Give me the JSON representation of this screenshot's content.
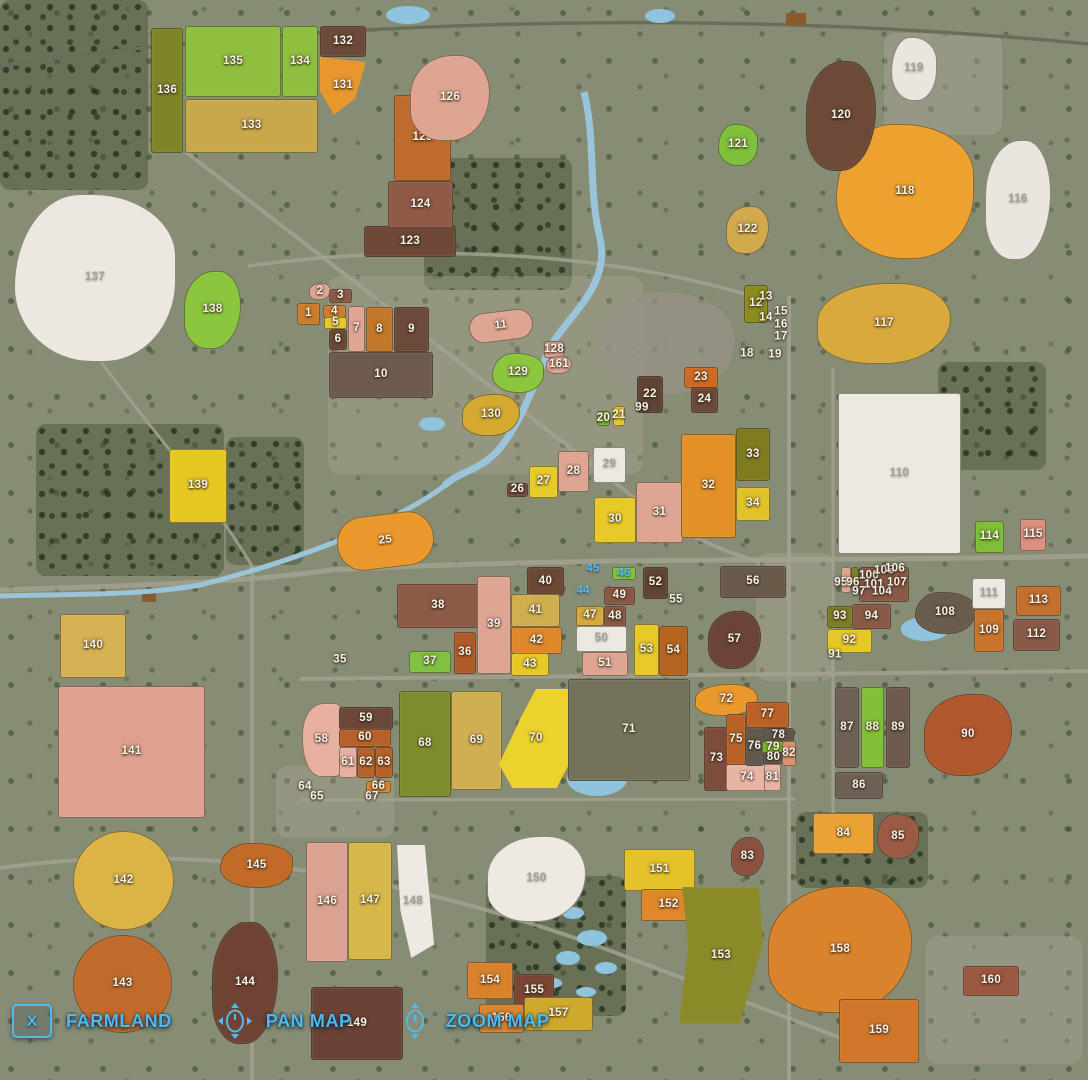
{
  "hud": {
    "close_key": "X",
    "farmland_label": "FARMLAND",
    "pan_label": "PAN MAP",
    "zoom_label": "ZOOM MAP",
    "accent_color": "#4dbbee",
    "pan_icon": "mouse-pan-icon",
    "zoom_icon": "mouse-zoom-icon"
  },
  "map": {
    "base_color": "#878d74",
    "label_default_color": "#f7f3ea",
    "fields": [
      [
        1,
        297,
        303,
        23,
        22,
        "#cc7d2a",
        "r"
      ],
      [
        2,
        309,
        283,
        22,
        17,
        "#dfa593",
        "b1"
      ],
      [
        3,
        329,
        289,
        23,
        14,
        "#8a5a44",
        "r"
      ],
      [
        4,
        323,
        305,
        23,
        13,
        "#cc7d2a",
        "r"
      ],
      [
        5,
        324,
        317,
        23,
        12,
        "#e7c928",
        "r"
      ],
      [
        6,
        329,
        329,
        18,
        21,
        "#6b4736",
        "r"
      ],
      [
        7,
        348,
        306,
        17,
        46,
        "#dfa593",
        "r"
      ],
      [
        8,
        366,
        307,
        27,
        45,
        "#c1782a",
        "r"
      ],
      [
        9,
        394,
        307,
        35,
        45,
        "#6b4a3a",
        "r"
      ],
      [
        10,
        329,
        352,
        104,
        46,
        "#6e5a4f",
        "r"
      ],
      [
        11,
        469,
        311,
        64,
        30,
        "#dfa593",
        "pill"
      ],
      [
        12,
        744,
        285,
        24,
        38,
        "#8b8b20",
        "r"
      ],
      [
        13,
        766,
        297
      ],
      [
        14,
        766,
        318
      ],
      [
        15,
        781,
        312
      ],
      [
        16,
        781,
        325
      ],
      [
        17,
        781,
        337
      ],
      [
        18,
        747,
        354
      ],
      [
        19,
        775,
        355
      ],
      [
        20,
        597,
        411,
        13,
        15,
        "#7ab32e",
        "r"
      ],
      [
        21,
        613,
        406,
        12,
        20,
        "#e7c928",
        "r"
      ],
      [
        22,
        637,
        376,
        26,
        37,
        "#5f4434",
        "r"
      ],
      [
        23,
        684,
        367,
        34,
        21,
        "#cc6a24",
        "r"
      ],
      [
        24,
        691,
        387,
        27,
        26,
        "#6b4a3c",
        "r"
      ],
      [
        25,
        337,
        514,
        97,
        54,
        "#e9992b",
        "pill"
      ],
      [
        26,
        507,
        483,
        21,
        14,
        "#6f4a3a",
        "r"
      ],
      [
        27,
        529,
        466,
        29,
        32,
        "#e8cb28",
        "r"
      ],
      [
        28,
        558,
        451,
        31,
        41,
        "#dfa593",
        "r"
      ],
      [
        29,
        593,
        447,
        33,
        36,
        "#ece8e2",
        "r",
        "gray"
      ],
      [
        30,
        594,
        497,
        42,
        46,
        "#e7c928",
        "r"
      ],
      [
        31,
        636,
        482,
        47,
        61,
        "#dfa593",
        "r"
      ],
      [
        32,
        681,
        434,
        55,
        104,
        "#e39127",
        "r"
      ],
      [
        33,
        736,
        428,
        34,
        53,
        "#7f7c20",
        "r"
      ],
      [
        34,
        736,
        487,
        34,
        34,
        "#e0c22a",
        "r"
      ],
      [
        35,
        340,
        660
      ],
      [
        36,
        454,
        632,
        22,
        42,
        "#b05a28",
        "r"
      ],
      [
        37,
        409,
        651,
        42,
        22,
        "#7fc242",
        "r"
      ],
      [
        38,
        397,
        584,
        82,
        44,
        "#8c5a46",
        "r"
      ],
      [
        39,
        477,
        576,
        34,
        98,
        "#dfa593",
        "r"
      ],
      [
        40,
        527,
        567,
        37,
        29,
        "#6b4736",
        "r"
      ],
      [
        41,
        511,
        594,
        49,
        33,
        "#cfae4f",
        "r"
      ],
      [
        42,
        511,
        627,
        51,
        27,
        "#e0872b",
        "r"
      ],
      [
        43,
        511,
        653,
        38,
        23,
        "#e7c928",
        "r"
      ],
      [
        44,
        583,
        591,
        null,
        null,
        null,
        null,
        "blue"
      ],
      [
        45,
        593,
        569,
        null,
        null,
        null,
        null,
        "blue"
      ],
      [
        46,
        612,
        567,
        24,
        13,
        "#7fc242",
        "r",
        "blue"
      ],
      [
        47,
        576,
        606,
        28,
        20,
        "#d2a93c",
        "r"
      ],
      [
        48,
        604,
        606,
        22,
        22,
        "#8a5744",
        "r"
      ],
      [
        49,
        604,
        587,
        31,
        18,
        "#8a5744",
        "r"
      ],
      [
        50,
        576,
        626,
        51,
        26,
        "#ece8e2",
        "r",
        "gray"
      ],
      [
        51,
        582,
        652,
        46,
        24,
        "#dfa593",
        "r"
      ],
      [
        52,
        643,
        567,
        25,
        32,
        "#5f4434",
        "r"
      ],
      [
        53,
        634,
        624,
        25,
        52,
        "#e7c928",
        "r"
      ],
      [
        54,
        659,
        626,
        29,
        50,
        "#b5641f",
        "r"
      ],
      [
        55,
        676,
        600
      ],
      [
        56,
        720,
        566,
        66,
        32,
        "#6a5a4a",
        "r"
      ],
      [
        57,
        708,
        611,
        53,
        58,
        "#6b4435",
        "b1"
      ],
      [
        58,
        302,
        703,
        39,
        74,
        "#e8b0a0",
        "q"
      ],
      [
        59,
        339,
        707,
        54,
        23,
        "#6b4738",
        "r"
      ],
      [
        60,
        339,
        729,
        52,
        18,
        "#b56129",
        "r"
      ],
      [
        61,
        339,
        747,
        18,
        31,
        "#e8b0a0",
        "r"
      ],
      [
        62,
        357,
        747,
        18,
        31,
        "#b56129",
        "r"
      ],
      [
        63,
        375,
        747,
        18,
        31,
        "#b56129",
        "r"
      ],
      [
        64,
        305,
        787
      ],
      [
        65,
        317,
        797
      ],
      [
        66,
        366,
        781,
        25,
        12,
        "#d9862e",
        "r"
      ],
      [
        67,
        372,
        797
      ],
      [
        68,
        399,
        691,
        52,
        106,
        "#7f8c2d",
        "r"
      ],
      [
        69,
        451,
        691,
        51,
        99,
        "#cfaf52",
        "r"
      ],
      [
        70,
        499,
        689,
        74,
        99,
        "#ecd22c",
        "w70"
      ],
      [
        71,
        568,
        679,
        122,
        102,
        "#74735a",
        "r"
      ],
      [
        72,
        695,
        684,
        63,
        32,
        "#e9992b",
        "b1"
      ],
      [
        73,
        704,
        727,
        25,
        64,
        "#7d4c3c",
        "r"
      ],
      [
        74,
        726,
        764,
        42,
        27,
        "#e8b5a5",
        "r"
      ],
      [
        75,
        726,
        714,
        20,
        51,
        "#b96228",
        "r"
      ],
      [
        76,
        745,
        727,
        19,
        39,
        "#62584e",
        "r"
      ],
      [
        77,
        746,
        702,
        43,
        26,
        "#b96228",
        "r"
      ],
      [
        78,
        763,
        728,
        31,
        15,
        "#5f564c",
        "r"
      ],
      [
        79,
        762,
        741,
        22,
        13,
        "#76b82a",
        "r"
      ],
      [
        80,
        763,
        752,
        21,
        12,
        "#5f564c",
        "r"
      ],
      [
        81,
        764,
        764,
        17,
        27,
        "#e8b5a5",
        "r"
      ],
      [
        82,
        782,
        741,
        14,
        25,
        "#d8936b",
        "r"
      ],
      [
        83,
        731,
        837,
        33,
        39,
        "#8a5140",
        "b1"
      ],
      [
        84,
        813,
        813,
        61,
        41,
        "#e9a233",
        "r"
      ],
      [
        85,
        877,
        814,
        42,
        45,
        "#9a5a44",
        "b2"
      ],
      [
        86,
        835,
        772,
        48,
        27,
        "#6e6055",
        "r"
      ],
      [
        87,
        835,
        687,
        24,
        81,
        "#6e6055",
        "r"
      ],
      [
        88,
        861,
        687,
        23,
        81,
        "#82c136",
        "r"
      ],
      [
        89,
        886,
        687,
        24,
        81,
        "#6e5a4e",
        "r"
      ],
      [
        90,
        924,
        694,
        88,
        82,
        "#b0572e",
        "b1"
      ],
      [
        91,
        835,
        655
      ],
      [
        92,
        827,
        629,
        45,
        24,
        "#e5c726",
        "r"
      ],
      [
        93,
        827,
        606,
        26,
        22,
        "#7d7c28",
        "r"
      ],
      [
        94,
        852,
        604,
        39,
        25,
        "#8a5a48",
        "r"
      ],
      [
        0,
        841,
        567,
        10,
        26,
        "#dfa593",
        "r"
      ],
      [
        0,
        851,
        567,
        8,
        22,
        "#7d7c28",
        "r"
      ],
      [
        0,
        865,
        567,
        10,
        14,
        "#e5c726",
        "r"
      ],
      [
        0,
        859,
        567,
        50,
        35,
        "#8a5a48",
        "r"
      ],
      [
        95,
        841,
        583
      ],
      [
        96,
        853,
        583
      ],
      [
        97,
        859,
        592
      ],
      [
        99,
        642,
        408
      ],
      [
        100,
        869,
        576
      ],
      [
        101,
        874,
        585
      ],
      [
        104,
        882,
        592
      ],
      [
        105,
        884,
        571
      ],
      [
        106,
        895,
        569
      ],
      [
        107,
        897,
        583
      ],
      [
        108,
        915,
        592,
        60,
        42,
        "#6a5c4c",
        "b2"
      ],
      [
        109,
        974,
        609,
        30,
        43,
        "#c8742c",
        "r"
      ],
      [
        110,
        838,
        393,
        123,
        161,
        "#ece8e2",
        "r",
        "gray"
      ],
      [
        111,
        972,
        578,
        34,
        31,
        "#ece8e2",
        "r",
        "gray"
      ],
      [
        112,
        1013,
        619,
        47,
        32,
        "#8a5a48",
        "r"
      ],
      [
        113,
        1016,
        586,
        45,
        30,
        "#c2702d",
        "r"
      ],
      [
        114,
        975,
        521,
        29,
        32,
        "#7dbf35",
        "r"
      ],
      [
        115,
        1020,
        519,
        26,
        32,
        "#d99080",
        "r"
      ],
      [
        116,
        985,
        140,
        66,
        120,
        "#eae6df",
        "b1",
        "gray"
      ],
      [
        117,
        817,
        283,
        134,
        81,
        "#d9a93e",
        "b1"
      ],
      [
        118,
        836,
        124,
        138,
        135,
        "#eda22f",
        "b2"
      ],
      [
        119,
        891,
        37,
        46,
        64,
        "#eae6df",
        "b2",
        "gray"
      ],
      [
        120,
        806,
        61,
        70,
        110,
        "#6d4937",
        "b1"
      ],
      [
        121,
        718,
        124,
        40,
        42,
        "#7ec13c",
        "b2"
      ],
      [
        122,
        726,
        206,
        43,
        48,
        "#d3a94e",
        "b1"
      ],
      [
        123,
        364,
        226,
        92,
        31,
        "#6f4736",
        "r"
      ],
      [
        124,
        388,
        181,
        65,
        47,
        "#8f5b46",
        "r"
      ],
      [
        125,
        394,
        95,
        57,
        86,
        "#bf6b2d",
        "r"
      ],
      [
        126,
        410,
        55,
        80,
        86,
        "#dfa593",
        "b1"
      ],
      [
        128,
        544,
        341,
        20,
        17,
        "#dfa593",
        "r"
      ],
      [
        129,
        492,
        353,
        52,
        40,
        "#8cc63f",
        "b2"
      ],
      [
        130,
        462,
        394,
        58,
        42,
        "#d3a930",
        "b1"
      ],
      [
        131,
        320,
        57,
        46,
        58,
        "#e8962e",
        "w131"
      ],
      [
        132,
        320,
        26,
        46,
        31,
        "#6b4a3a",
        "r"
      ],
      [
        133,
        185,
        99,
        133,
        54,
        "#c9a84c",
        "r"
      ],
      [
        134,
        282,
        26,
        36,
        71,
        "#8fbf3f",
        "r"
      ],
      [
        135,
        185,
        26,
        96,
        71,
        "#8fbf3f",
        "r"
      ],
      [
        136,
        151,
        28,
        32,
        125,
        "#7e8428",
        "r"
      ],
      [
        137,
        14,
        194,
        162,
        168,
        "#ece8e0",
        "b2",
        "gray"
      ],
      [
        138,
        184,
        271,
        57,
        78,
        "#8cc63f",
        "b1"
      ],
      [
        139,
        169,
        449,
        58,
        74,
        "#e5c722",
        "r"
      ],
      [
        140,
        60,
        614,
        66,
        64,
        "#d6b254",
        "r"
      ],
      [
        141,
        58,
        686,
        147,
        132,
        "#dfa08f",
        "r"
      ],
      [
        142,
        73,
        831,
        101,
        99,
        "#dcb446",
        "ci"
      ],
      [
        143,
        73,
        935,
        99,
        98,
        "#c06b2b",
        "ci"
      ],
      [
        144,
        212,
        922,
        66,
        122,
        "#6e4334",
        "b1"
      ],
      [
        145,
        220,
        843,
        73,
        45,
        "#c26a28",
        "b2"
      ],
      [
        146,
        306,
        842,
        42,
        120,
        "#dba292",
        "r"
      ],
      [
        147,
        348,
        842,
        44,
        118,
        "#d5b74a",
        "r"
      ],
      [
        148,
        392,
        845,
        42,
        113,
        "#efe9e4",
        "w148",
        "gray"
      ],
      [
        149,
        311,
        987,
        92,
        73,
        "#6b4336",
        "r"
      ],
      [
        150,
        487,
        836,
        99,
        86,
        "#efe9e4",
        "b1",
        "gray"
      ],
      [
        151,
        624,
        849,
        71,
        42,
        "#e3c329",
        "r"
      ],
      [
        152,
        641,
        889,
        55,
        32,
        "#e0872b",
        "r"
      ],
      [
        153,
        679,
        887,
        84,
        137,
        "#8a8a28",
        "w153"
      ],
      [
        154,
        467,
        962,
        46,
        37,
        "#d9822c",
        "r"
      ],
      [
        155,
        514,
        974,
        40,
        33,
        "#7a4535",
        "r"
      ],
      [
        156,
        479,
        1004,
        45,
        29,
        "#d9862e",
        "r"
      ],
      [
        157,
        524,
        997,
        69,
        34,
        "#cfa92c",
        "r"
      ],
      [
        158,
        768,
        886,
        144,
        127,
        "#d9832b",
        "b1"
      ],
      [
        159,
        839,
        999,
        80,
        64,
        "#d0762a",
        "r"
      ],
      [
        160,
        963,
        966,
        56,
        30,
        "#9a5843",
        "r"
      ],
      [
        161,
        546,
        356,
        26,
        18,
        "#dfa593",
        "b1"
      ]
    ]
  }
}
